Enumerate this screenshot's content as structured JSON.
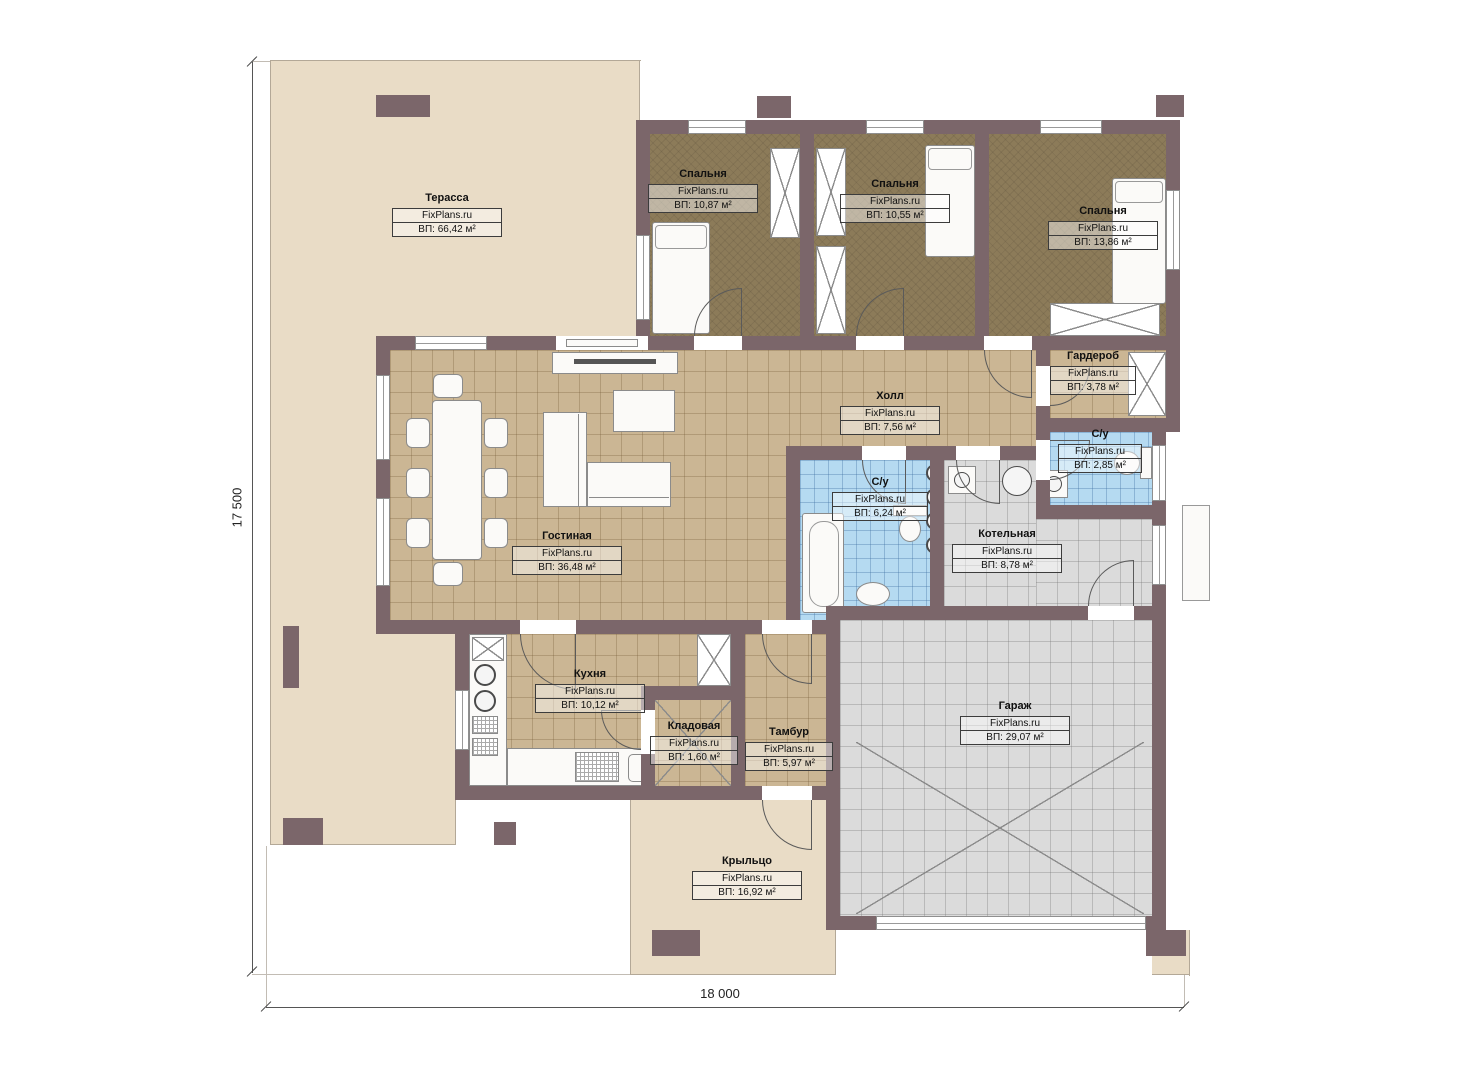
{
  "watermark": "FixPlans.ru",
  "dimensions": {
    "vertical": "17 500",
    "horizontal": "18 000"
  },
  "rooms": [
    {
      "id": "terrace",
      "name": "Терасса",
      "area": "ВП: 66,42 м²"
    },
    {
      "id": "bedroom1",
      "name": "Спальня",
      "area": "ВП: 10,87 м²"
    },
    {
      "id": "bedroom2",
      "name": "Спальня",
      "area": "ВП: 10,55 м²"
    },
    {
      "id": "bedroom3",
      "name": "Спальня",
      "area": "ВП: 13,86 м²"
    },
    {
      "id": "wardrobe",
      "name": "Гардероб",
      "area": "ВП: 3,78 м²"
    },
    {
      "id": "hall",
      "name": "Холл",
      "area": "ВП: 7,56 м²"
    },
    {
      "id": "bath-small",
      "name": "С/у",
      "area": "ВП: 2,85 м²"
    },
    {
      "id": "bath-main",
      "name": "С/у",
      "area": "ВП: 6,24 м²"
    },
    {
      "id": "boiler",
      "name": "Котельная",
      "area": "ВП: 8,78 м²"
    },
    {
      "id": "living",
      "name": "Гостиная",
      "area": "ВП: 36,48 м²"
    },
    {
      "id": "kitchen",
      "name": "Кухня",
      "area": "ВП: 10,12 м²"
    },
    {
      "id": "pantry",
      "name": "Кладовая",
      "area": "ВП: 1,60 м²"
    },
    {
      "id": "vestibule",
      "name": "Тамбур",
      "area": "ВП: 5,97 м²"
    },
    {
      "id": "garage",
      "name": "Гараж",
      "area": "ВП: 29,07 м²"
    },
    {
      "id": "porch",
      "name": "Крыльцо",
      "area": "ВП: 16,92 м²"
    }
  ],
  "colors": {
    "wall": "#7b666a",
    "terrace": "#e9dcc6",
    "bedroom_floor": "#8c7b59",
    "tile_tan": "#cbb694",
    "tile_blue": "#b5daf1",
    "tile_gray": "#dbdbdb"
  }
}
